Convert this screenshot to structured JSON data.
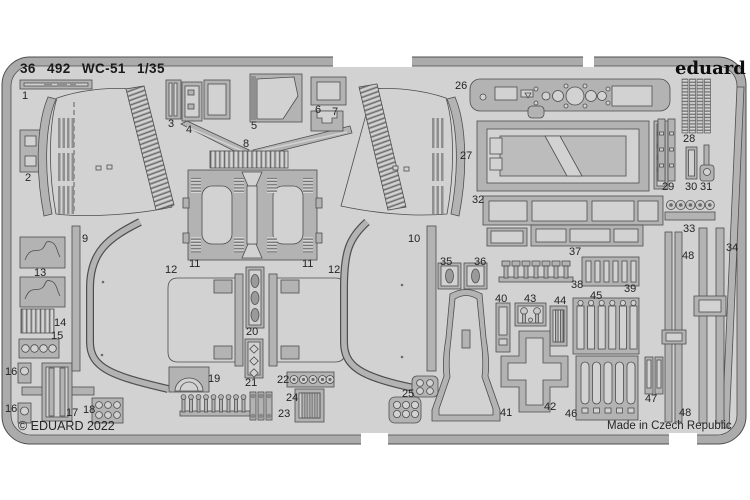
{
  "header": {
    "title": "36 492  WC-51  1/35",
    "brand": "eduard"
  },
  "footer": {
    "copyright": "© EDUARD 2022",
    "made_in": "Made in Czech Republic"
  },
  "colors": {
    "background": "#ffffff",
    "sheet": "#d2d2d2",
    "frame": "#ababab",
    "part": "#b3b3b3",
    "outline": "#4e4e4e",
    "text": "#242424",
    "brand_text": "#0d0d0d"
  },
  "part_labels": [
    {
      "n": "1",
      "x": 22,
      "y": 91
    },
    {
      "n": "2",
      "x": 25,
      "y": 173
    },
    {
      "n": "3",
      "x": 168,
      "y": 119
    },
    {
      "n": "4",
      "x": 186,
      "y": 125
    },
    {
      "n": "5",
      "x": 251,
      "y": 121
    },
    {
      "n": "6",
      "x": 315,
      "y": 105
    },
    {
      "n": "7",
      "x": 332,
      "y": 107
    },
    {
      "n": "8",
      "x": 243,
      "y": 139
    },
    {
      "n": "9",
      "x": 82,
      "y": 234
    },
    {
      "n": "10",
      "x": 408,
      "y": 234
    },
    {
      "n": "11",
      "x": 189,
      "y": 259
    },
    {
      "n": "11",
      "x": 302,
      "y": 259
    },
    {
      "n": "12",
      "x": 165,
      "y": 265
    },
    {
      "n": "12",
      "x": 328,
      "y": 265
    },
    {
      "n": "13",
      "x": 34,
      "y": 268
    },
    {
      "n": "14",
      "x": 54,
      "y": 318
    },
    {
      "n": "15",
      "x": 51,
      "y": 331
    },
    {
      "n": "16",
      "x": 5,
      "y": 367
    },
    {
      "n": "16",
      "x": 5,
      "y": 404
    },
    {
      "n": "17",
      "x": 66,
      "y": 408
    },
    {
      "n": "18",
      "x": 83,
      "y": 405
    },
    {
      "n": "19",
      "x": 208,
      "y": 374
    },
    {
      "n": "20",
      "x": 246,
      "y": 327
    },
    {
      "n": "21",
      "x": 245,
      "y": 378
    },
    {
      "n": "22",
      "x": 277,
      "y": 375
    },
    {
      "n": "23",
      "x": 278,
      "y": 409
    },
    {
      "n": "24",
      "x": 286,
      "y": 393
    },
    {
      "n": "25",
      "x": 402,
      "y": 389
    },
    {
      "n": "26",
      "x": 455,
      "y": 81
    },
    {
      "n": "27",
      "x": 460,
      "y": 151
    },
    {
      "n": "28",
      "x": 683,
      "y": 134
    },
    {
      "n": "29",
      "x": 662,
      "y": 182
    },
    {
      "n": "30",
      "x": 685,
      "y": 182
    },
    {
      "n": "31",
      "x": 700,
      "y": 182
    },
    {
      "n": "32",
      "x": 472,
      "y": 195
    },
    {
      "n": "33",
      "x": 683,
      "y": 224
    },
    {
      "n": "34",
      "x": 726,
      "y": 243
    },
    {
      "n": "35",
      "x": 440,
      "y": 257
    },
    {
      "n": "36",
      "x": 474,
      "y": 257
    },
    {
      "n": "37",
      "x": 569,
      "y": 247
    },
    {
      "n": "38",
      "x": 571,
      "y": 280
    },
    {
      "n": "39",
      "x": 624,
      "y": 284
    },
    {
      "n": "40",
      "x": 495,
      "y": 294
    },
    {
      "n": "41",
      "x": 500,
      "y": 408
    },
    {
      "n": "42",
      "x": 544,
      "y": 402
    },
    {
      "n": "43",
      "x": 524,
      "y": 294
    },
    {
      "n": "44",
      "x": 554,
      "y": 296
    },
    {
      "n": "45",
      "x": 590,
      "y": 291
    },
    {
      "n": "46",
      "x": 565,
      "y": 409
    },
    {
      "n": "47",
      "x": 645,
      "y": 394
    },
    {
      "n": "48",
      "x": 682,
      "y": 251
    },
    {
      "n": "48",
      "x": 679,
      "y": 408
    }
  ]
}
